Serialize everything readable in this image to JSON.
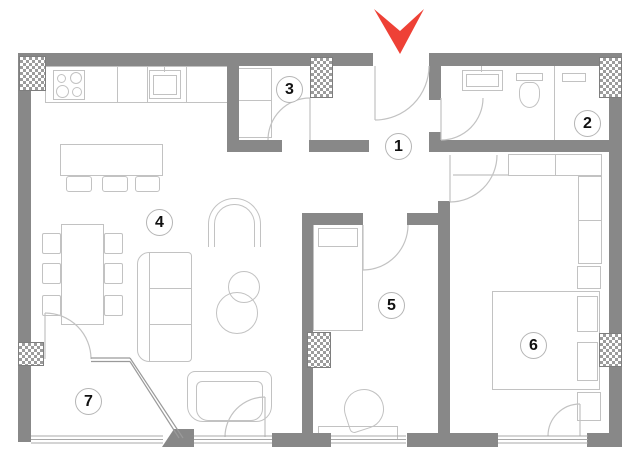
{
  "floor_plan": {
    "kind": "apartment-floor-plan",
    "rooms": [
      {
        "number": "1"
      },
      {
        "number": "2"
      },
      {
        "number": "3"
      },
      {
        "number": "4"
      },
      {
        "number": "5"
      },
      {
        "number": "6"
      },
      {
        "number": "7"
      }
    ],
    "entrance": {
      "marker": "red-arrow-down"
    },
    "colors": {
      "wall": "#888888",
      "hatch": "#9c9c9c",
      "furniture_line": "#c2c2c2",
      "window_line": "#a8a8a8",
      "arrow": "#ee4136",
      "label_text": "#111111"
    }
  }
}
